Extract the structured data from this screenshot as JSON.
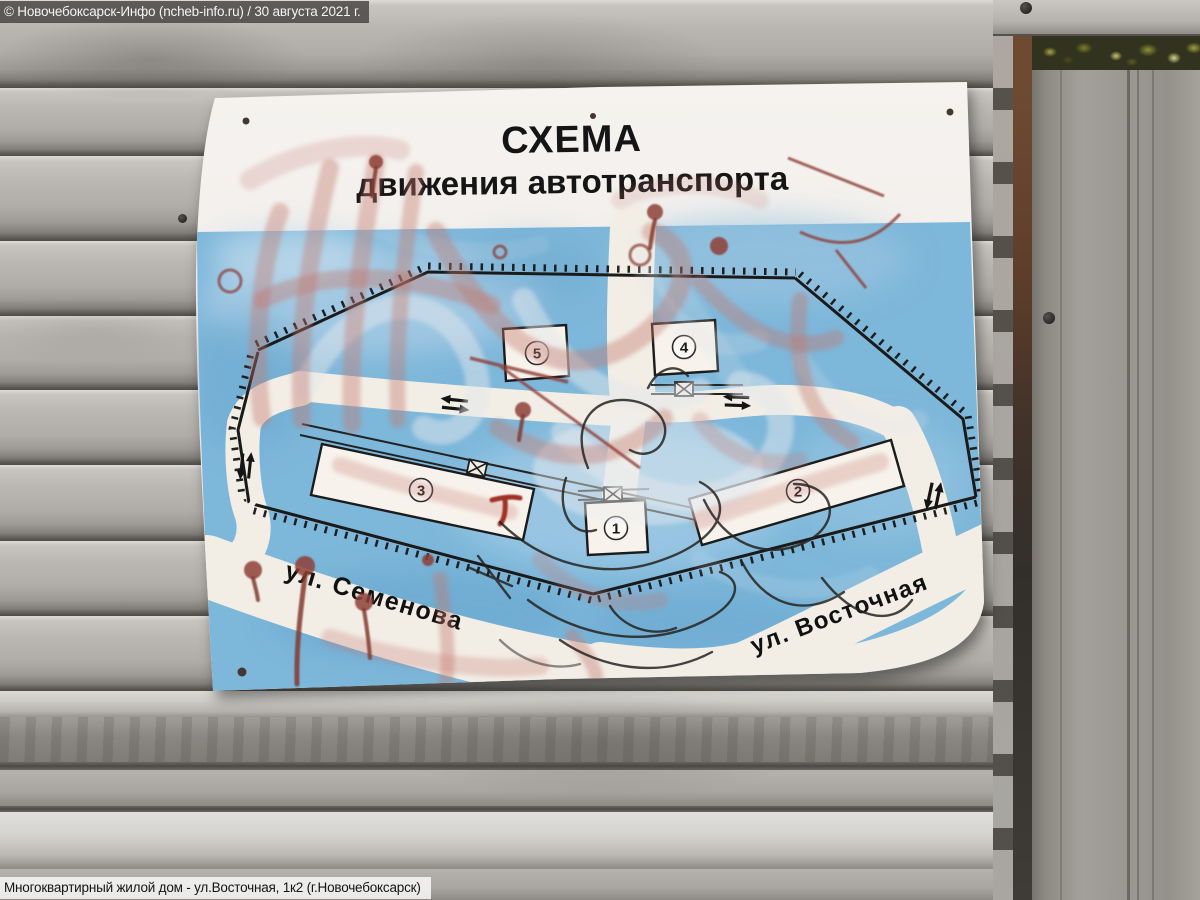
{
  "photo": {
    "watermark_top": "© Новочебоксарск-Инфо (ncheb-info.ru) / 30 августа 2021 г.",
    "caption_bottom": "Многоквартирный жилой дом - ул.Восточная, 1к2 (г.Новочебоксарск)"
  },
  "poster": {
    "title_line1": "СХЕМА",
    "title_line2": "движения автотранспорта",
    "streets": [
      {
        "name": "ул. Семенова"
      },
      {
        "name": "ул. Восточная"
      }
    ],
    "buildings": [
      {
        "label": "1"
      },
      {
        "label": "2"
      },
      {
        "label": "3"
      },
      {
        "label": "4"
      },
      {
        "label": "5"
      }
    ],
    "colors": {
      "map_blue": "#7db7da",
      "road_white": "#f2eee6",
      "poster_white": "#f4f1ec",
      "graffiti_pink": "#c47a6e",
      "graffiti_dark_red": "#8e4038",
      "line_black": "#1a1a1a"
    }
  }
}
